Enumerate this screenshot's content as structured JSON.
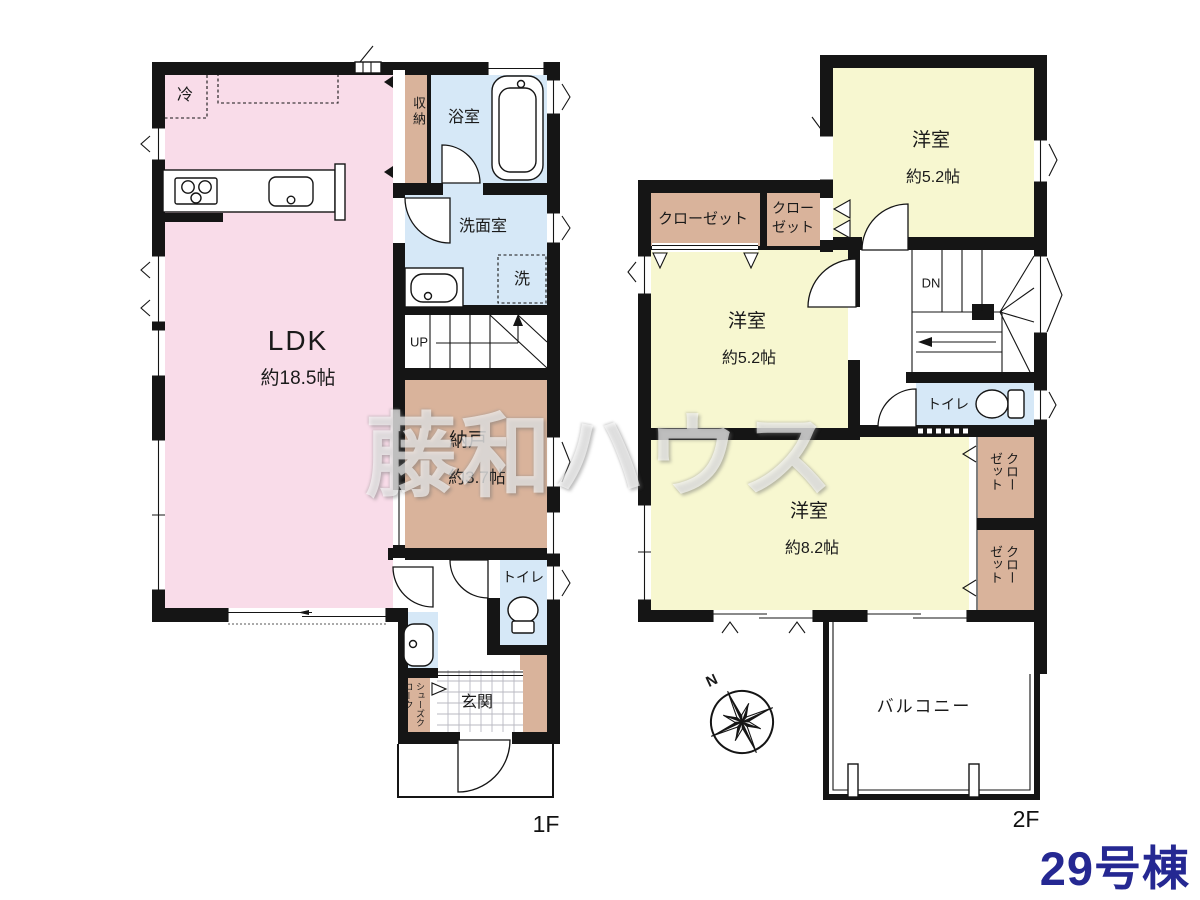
{
  "unit": {
    "label": "29号棟"
  },
  "watermark": {
    "text": "藤和ハウス"
  },
  "colors": {
    "ldk_pink": "#F9DCE9",
    "room_yellow": "#F7F7D0",
    "wet_blue": "#D6E8F7",
    "storage_tan": "#D9B39B",
    "wall": "#151515",
    "unit_text": "#252892"
  },
  "floor1": {
    "label": "1F",
    "ldk_name": "LDK",
    "ldk_size": "約18.5帖",
    "nando_name": "納戸",
    "nando_size": "約3.7帖",
    "bath": "浴室",
    "washroom": "洗面室",
    "storage": "収納",
    "toilet": "トイレ",
    "entrance": "玄関",
    "shoes_closet": "シューズクローク",
    "fridge": "冷",
    "washer": "洗",
    "stairs_up": "UP"
  },
  "floor2": {
    "label": "2F",
    "western1_name": "洋室",
    "western1_size": "約5.2帖",
    "western2_name": "洋室",
    "western2_size": "約5.2帖",
    "western3_name": "洋室",
    "western3_size": "約8.2帖",
    "closet_a": "クローゼット",
    "closet_b": "クローゼット",
    "closet_c": "クローゼット",
    "closet_d": "クローゼット",
    "toilet": "トイレ",
    "balcony": "バルコニー",
    "stairs_down": "DN",
    "compass_north": "N"
  }
}
